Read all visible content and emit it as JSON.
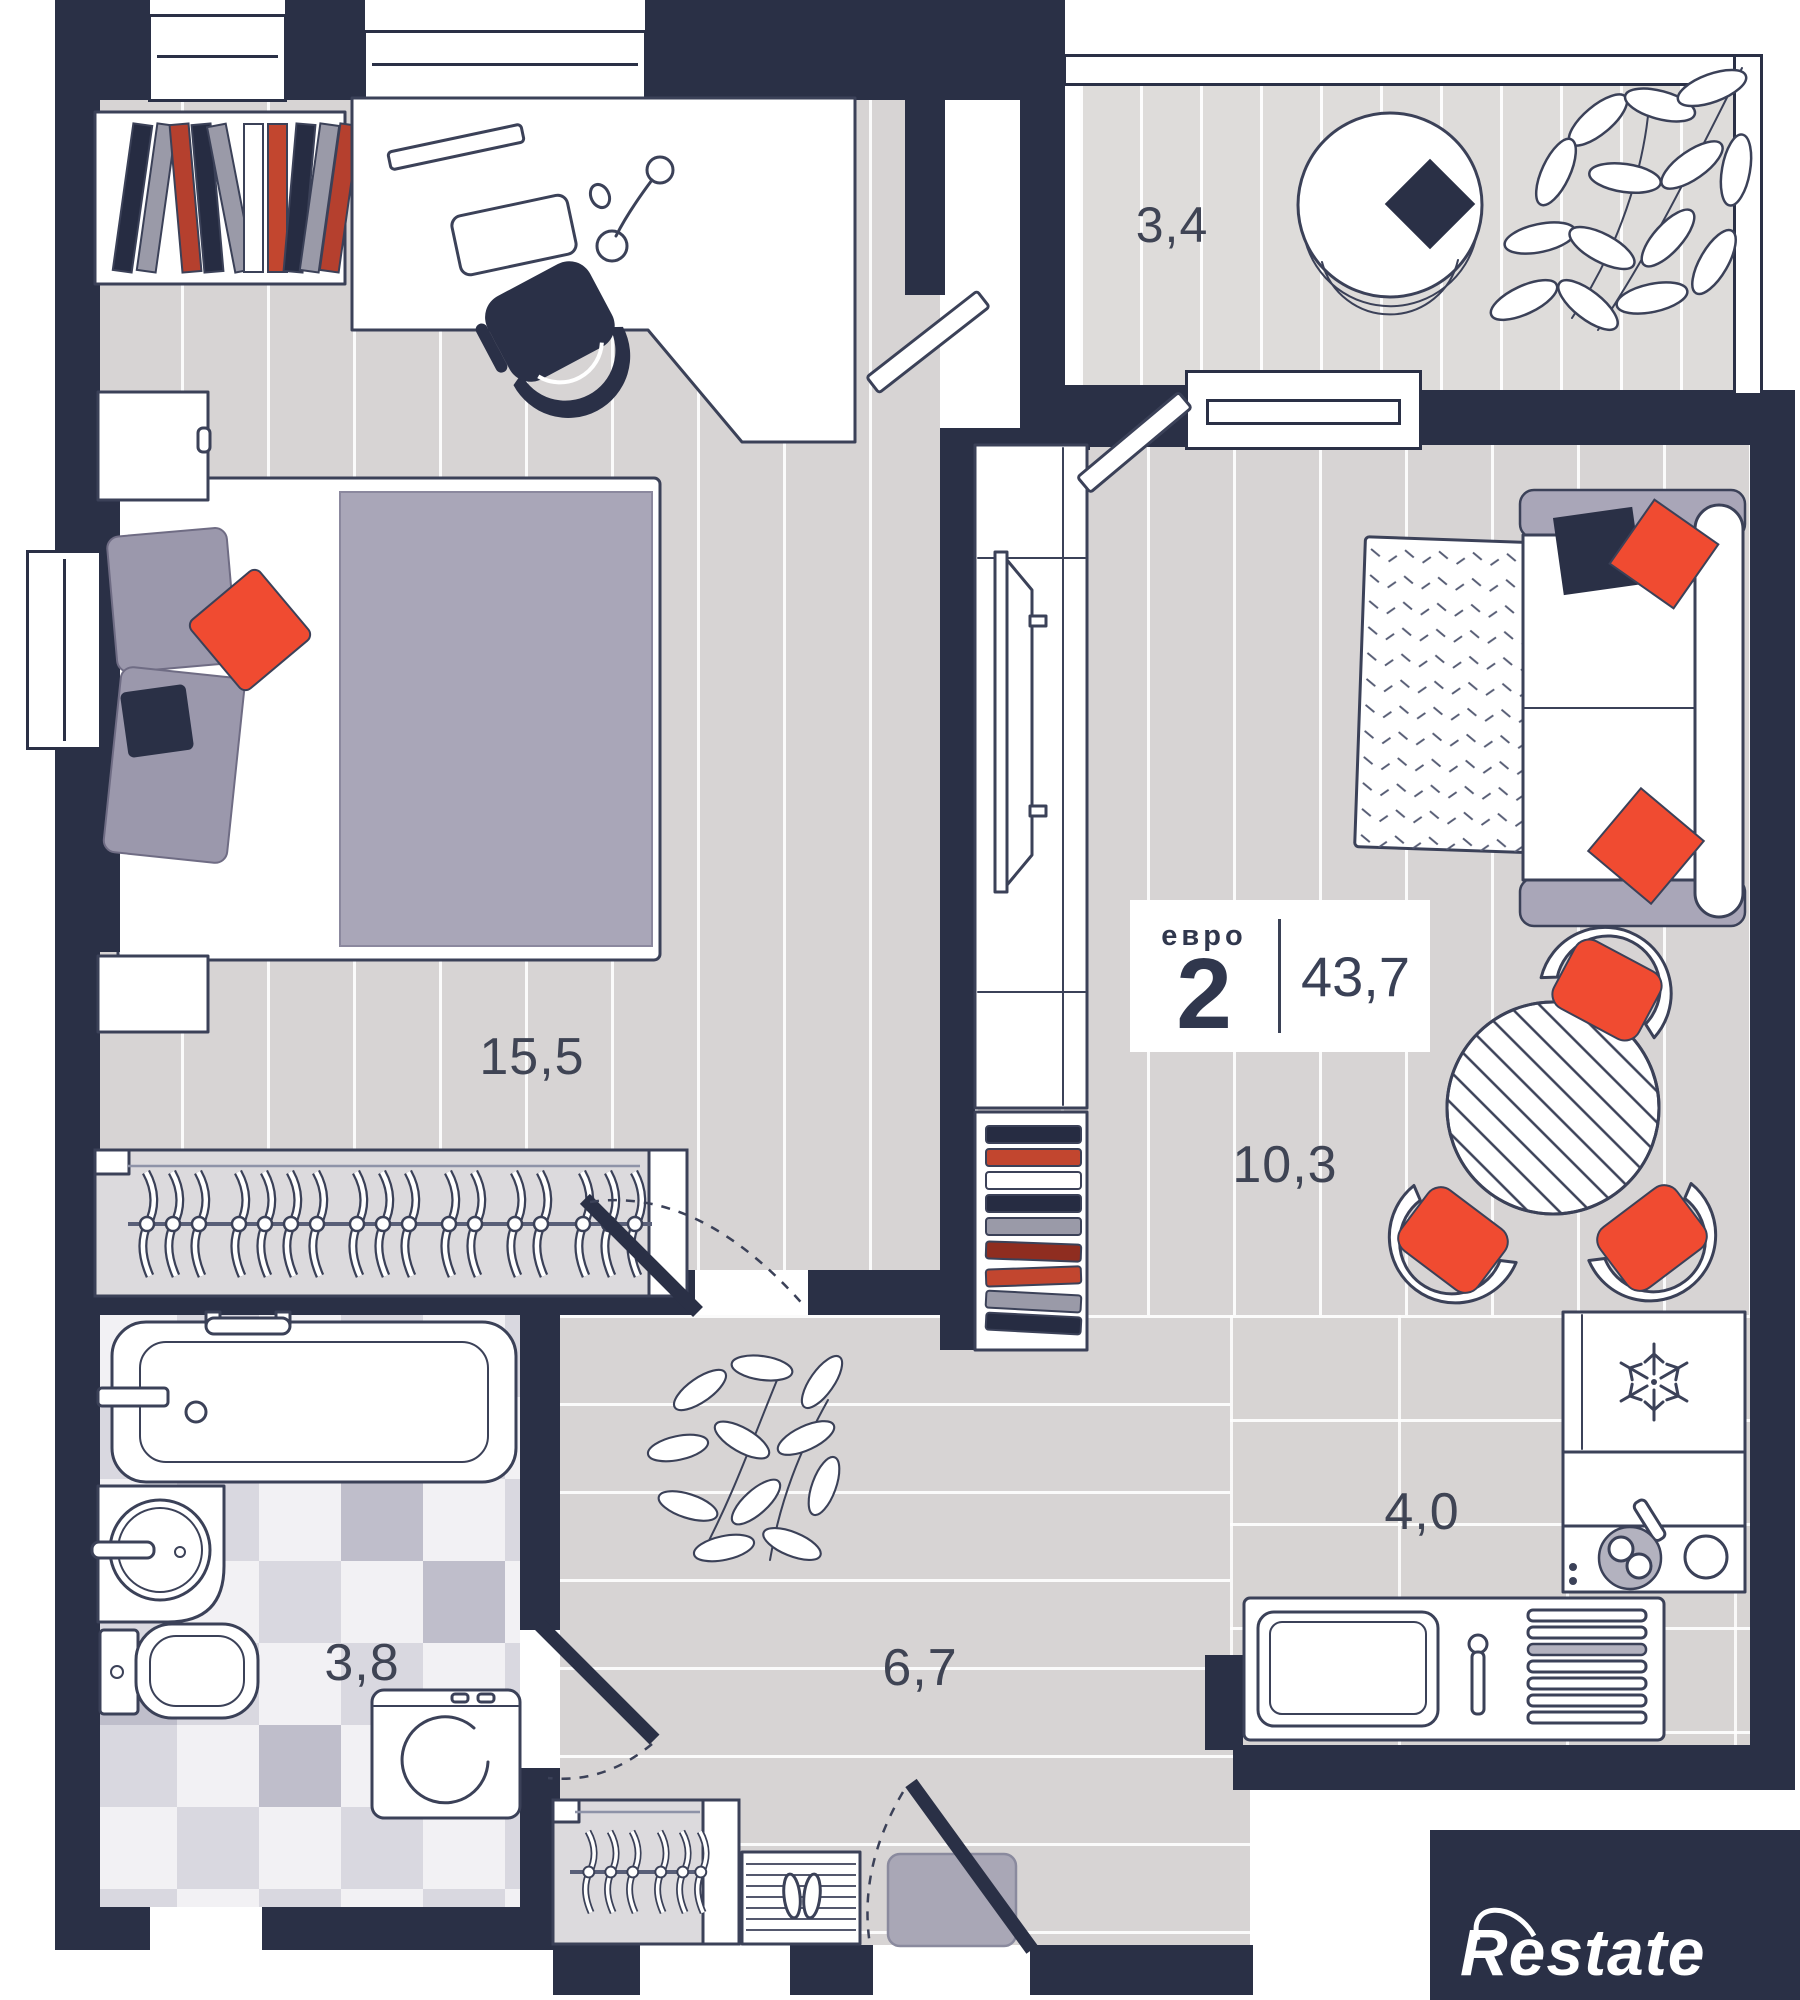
{
  "plan": {
    "badge": {
      "type_label": "евро",
      "type_number": "2",
      "total_area": "43,7"
    },
    "rooms": {
      "balcony": {
        "area": "3,4"
      },
      "bedroom": {
        "area": "15,5"
      },
      "living_room": {
        "area": "10,3"
      },
      "kitchen": {
        "area": "4,0"
      },
      "bathroom": {
        "area": "3,8"
      },
      "hallway": {
        "area": "6,7"
      }
    },
    "watermark": {
      "text": "Restate"
    },
    "colors": {
      "wall": "#2a3046",
      "accent_red": "#f04b31",
      "floor": "#d7d4d4",
      "textile": "#a9a6b8",
      "label_text": "#3f4454",
      "line": "#3b4158"
    }
  }
}
